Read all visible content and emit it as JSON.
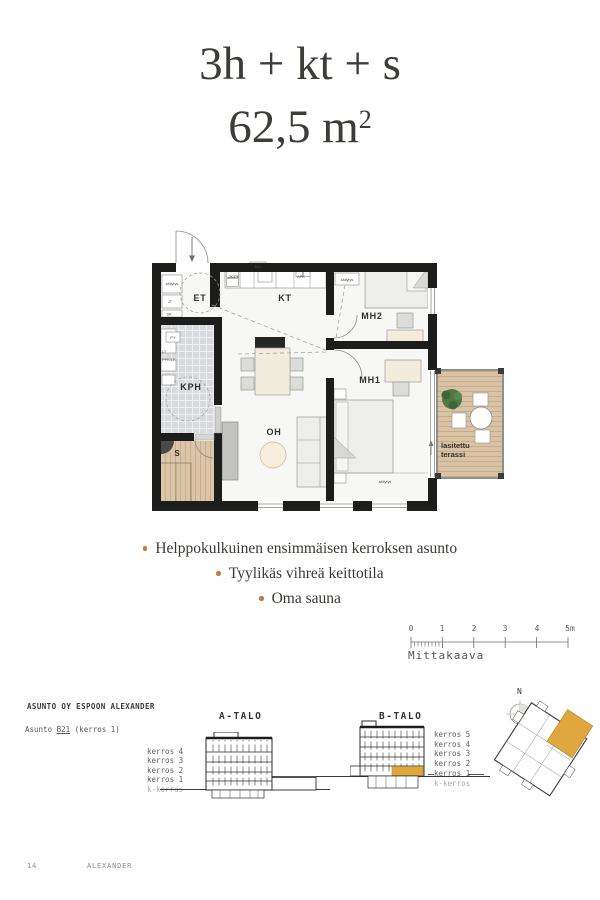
{
  "header": {
    "title": "3h + kt + s",
    "area": "62,5 m",
    "area_sup": "2"
  },
  "plan": {
    "rooms": {
      "et": "ET",
      "kt": "KT",
      "kph": "KPH",
      "sauna": "S",
      "oh": "OH",
      "mh1": "MH1",
      "mh2": "MH2"
    },
    "terrace": {
      "line1": "lasitettu",
      "line2": "terassi"
    },
    "small_labels": {
      "sailytys_hall": "säilytys",
      "jt": "JT",
      "sk": "SK",
      "mu": "MU",
      "jk_pk": "JK/PK",
      "apk": "APK",
      "sailytys_mh2": "säilytys",
      "sailytys_mh1": "säilytys",
      "py": "PY",
      "lt": "LT",
      "ppk_lk": "PPK/LK"
    }
  },
  "features": {
    "items": [
      {
        "text": "Helppokulkuinen ensimmäisen kerroksen asunto"
      },
      {
        "text": "Tyylikäs vihreä keittotila"
      },
      {
        "text": "Oma sauna"
      }
    ]
  },
  "scale_bar": {
    "labels": [
      "0",
      "1",
      "2",
      "3",
      "4",
      "5m"
    ],
    "caption": "Mittakaava"
  },
  "project": {
    "company": "ASUNTO OY ESPOON ALEXANDER",
    "apartment_prefix": "Asunto",
    "apartment_unit": "B21",
    "apartment_suffix": "(kerros 1)"
  },
  "elevations": {
    "a_building": {
      "name": "A-TALO",
      "floors": [
        "kerros 4",
        "kerros 3",
        "kerros 2",
        "kerros 1",
        "k-kerros"
      ]
    },
    "b_building": {
      "name": "B-TALO",
      "floors": [
        "kerros 5",
        "kerros 4",
        "kerros 3",
        "kerros 2",
        "kerros 1",
        "k-kerros"
      ]
    }
  },
  "compass": {
    "north": "N"
  },
  "footer": {
    "page_number": "14",
    "project": "ALEXANDER"
  },
  "colors": {
    "ink": "#3e3c38",
    "wall": "#1d1d1b",
    "accent_gold": "#dfa73e",
    "bullet": "#bf7c3e",
    "wood": "#d9c3a6",
    "tile": "#d9dade"
  }
}
